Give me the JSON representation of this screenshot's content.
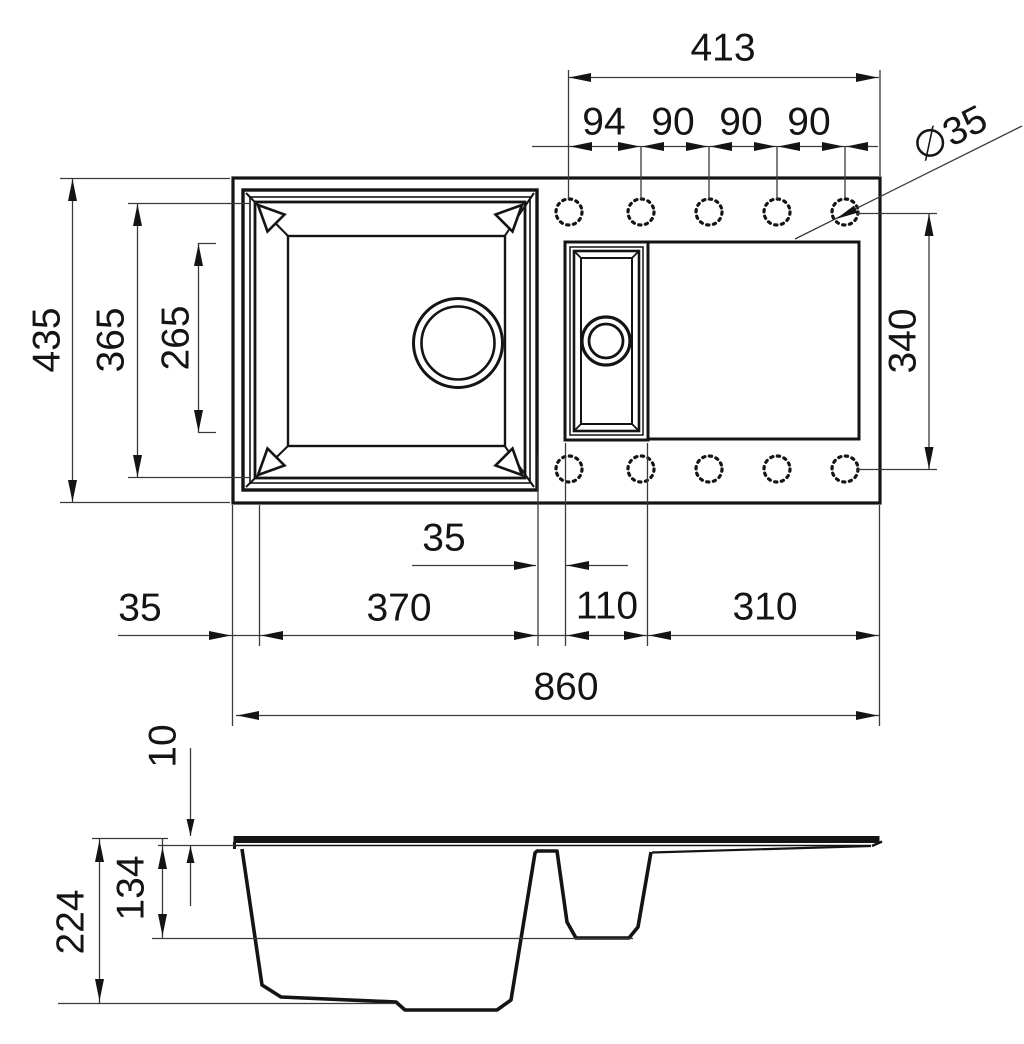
{
  "drawing": {
    "description": "Dimensioned technical drawing of a one-and-a-half bowl kitchen sink with drainboard: plan view (top) and section view (bottom)",
    "units": "mm",
    "ink_color": "#141414",
    "background_color": "#ffffff"
  },
  "labels": {
    "hole_span": "413",
    "hole_pitch_1": "94",
    "hole_pitch_2": "90",
    "hole_pitch_3": "90",
    "hole_pitch_4": "90",
    "hole_diameter": "∅35",
    "overall_depth": "435",
    "bowl_outer_depth": "365",
    "bowl_inner_depth": "265",
    "hole_rows_span": "340",
    "left_edge_offset": "35",
    "main_bowl_width": "370",
    "bowl_gap": "35",
    "half_bowl_width": "110",
    "drainer_width": "310",
    "overall_width": "860",
    "rim_thickness": "10",
    "half_bowl_depth": "134",
    "main_bowl_depth": "224"
  }
}
